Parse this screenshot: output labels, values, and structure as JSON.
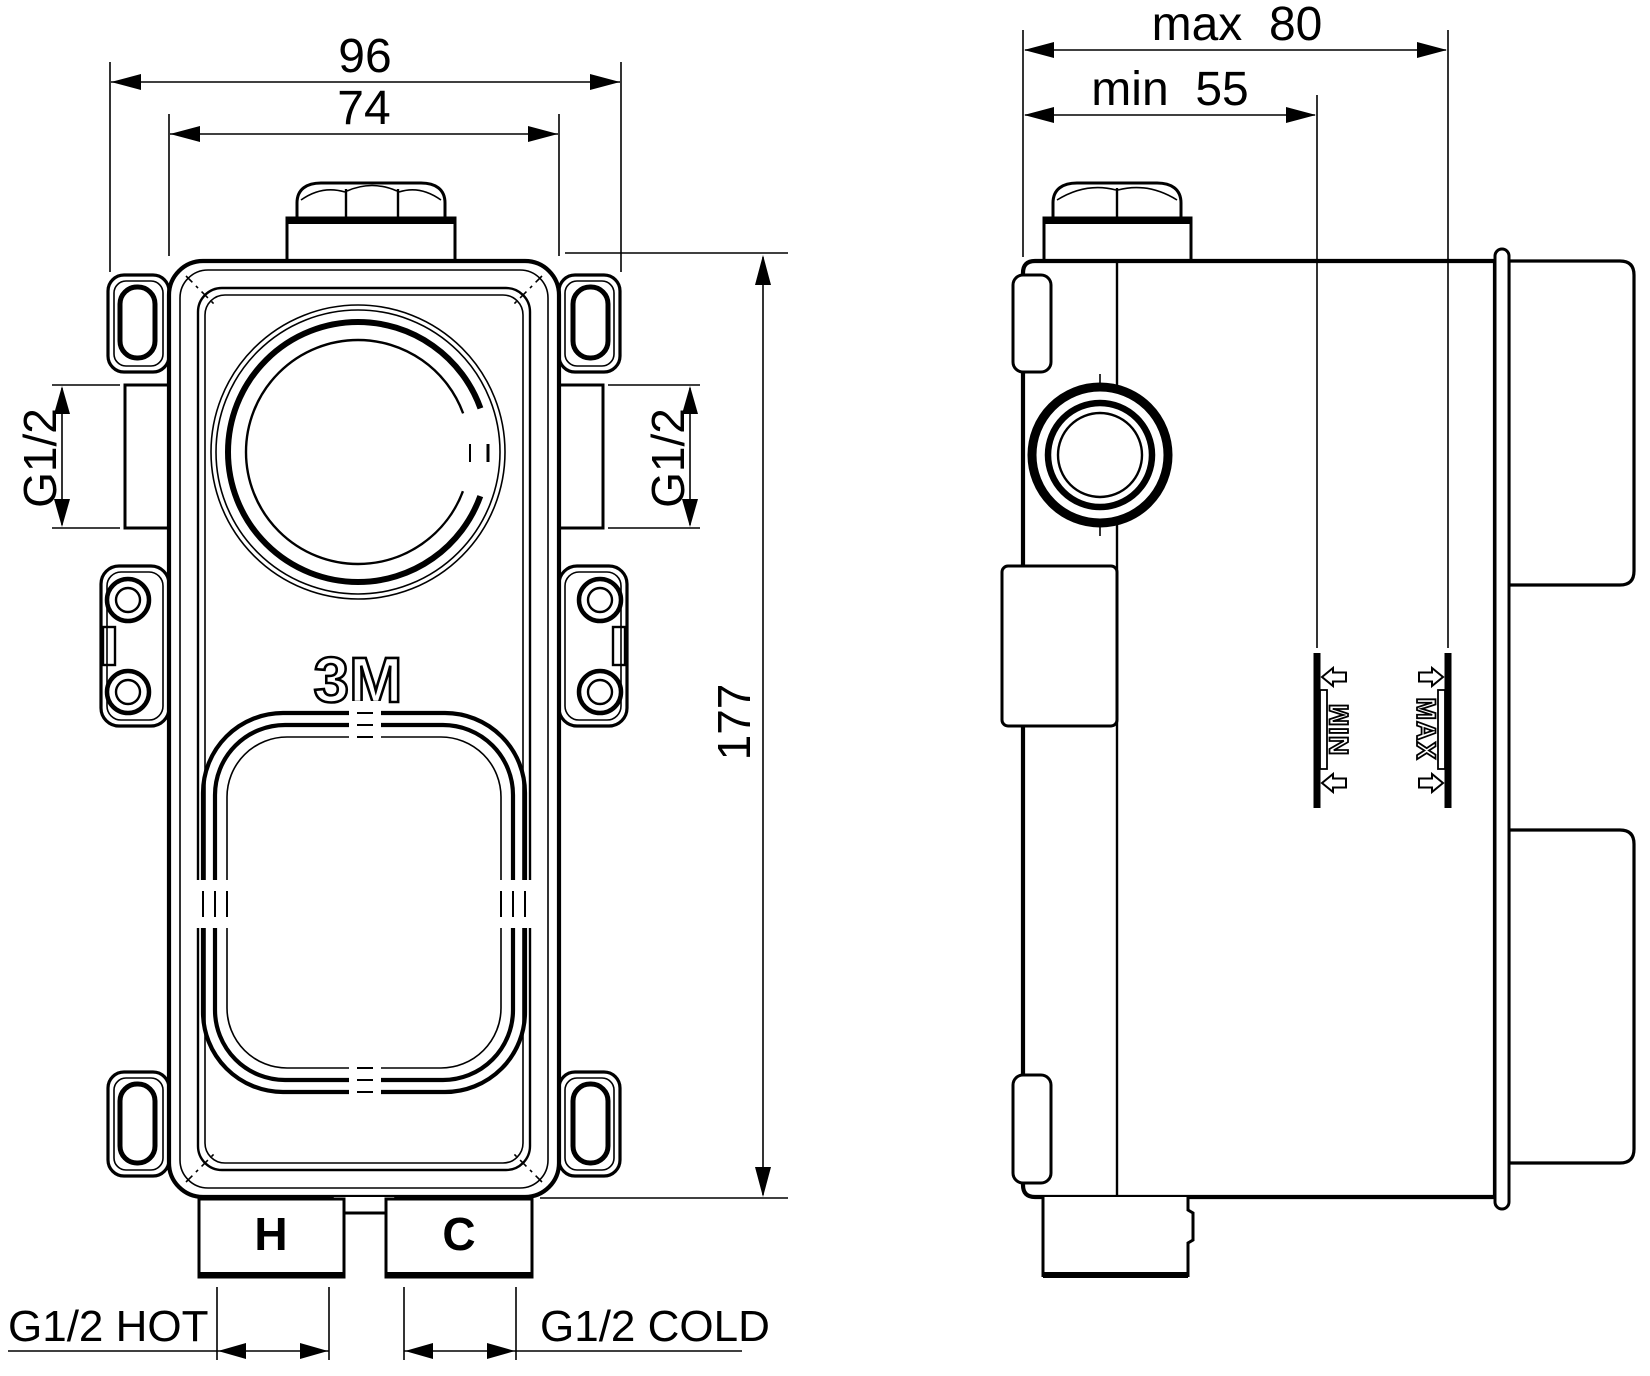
{
  "drawing": {
    "front_view": {
      "width_overall": "96",
      "width_inner": "74",
      "height": "177",
      "thread_left": "G1/2",
      "thread_right": "G1/2",
      "hot_inlet_label": "G1/2 HOT",
      "cold_inlet_label": "G1/2 COLD",
      "hot_port_mark": "H",
      "cold_port_mark": "C",
      "logo": "3M"
    },
    "side_view": {
      "depth_max": "max  80",
      "depth_min": "min  55",
      "wall_max_mark": "MAX",
      "wall_min_mark": "MIN",
      "wall_min_mark_stacked": "NIM"
    },
    "colors": {
      "line": "#000000",
      "background": "#ffffff"
    }
  }
}
